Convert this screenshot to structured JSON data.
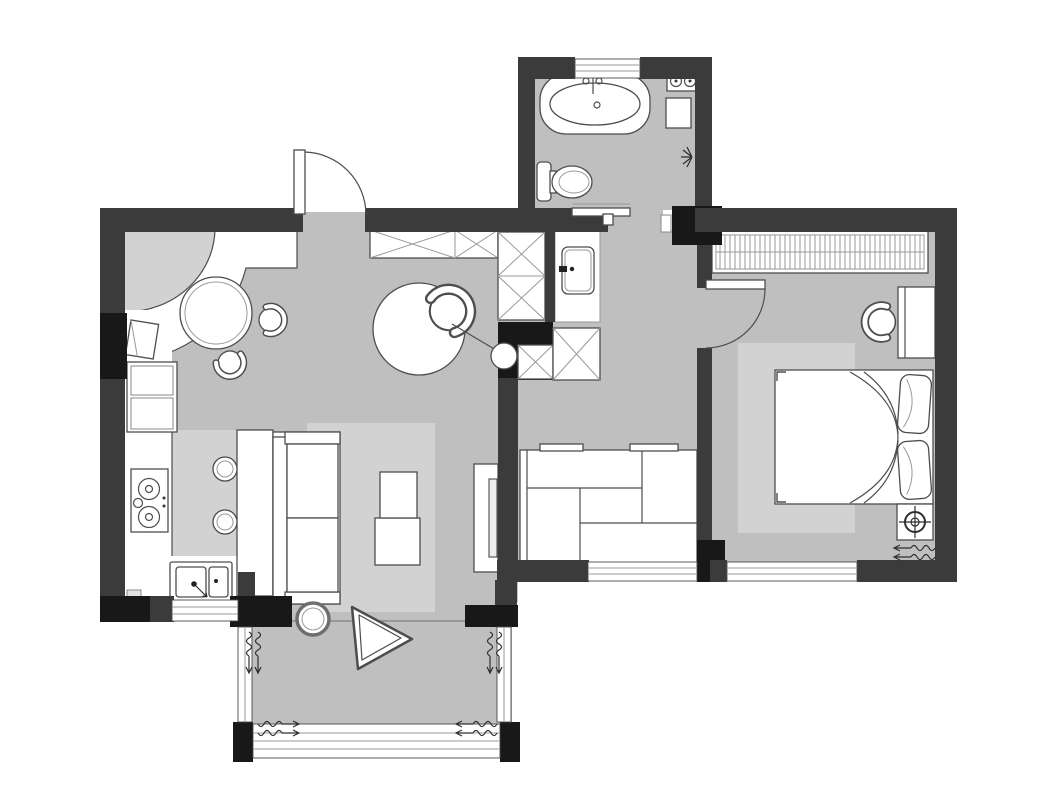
{
  "document": {
    "type": "apartment-floor-plan",
    "style": "top-down black / grey architectural drawing, no text labels",
    "background": "#ffffff"
  },
  "palette": {
    "wall": "#3b3b3b",
    "structural_column": "#181818",
    "floor": "#bfbfbf",
    "floor_light": "#d2d2d2",
    "fixture_fill": "#ffffff",
    "outline": "#4d4d4d",
    "window_line": "#9a9a9a"
  },
  "rooms": [
    {
      "id": "kitchen-dining",
      "label": "Kitchen and dining area",
      "features": [
        "curved countertop in top-left corner",
        "angled fridge",
        "tall two-door cabinet",
        "two-burner gas cooktop",
        "double-bowl sink with drain arrow",
        "window under sink",
        "round dining table",
        "two tub chairs"
      ]
    },
    {
      "id": "entry-hall",
      "label": "Entry hall",
      "features": [
        "outward swinging entry door in top wall",
        "row of X storage cabinets",
        "column of X storage cabinets",
        "round rug",
        "tub armchair",
        "floor lamp with small round head"
      ]
    },
    {
      "id": "living-room",
      "label": "Living room",
      "features": [
        "bar console behind sofa",
        "two round bar stools",
        "two-seat sofa facing east",
        "light grey rug",
        "two-piece coffee table",
        "TV on low cabinet against partition wall",
        "south window"
      ]
    },
    {
      "id": "inner-hall-nook",
      "label": "Inner hall and storage nook",
      "features": [
        "washbasin vanity outside bathroom",
        "X cabinets beside vanity",
        "large staggered-panel storage cabinet with two handles",
        "south window"
      ]
    },
    {
      "id": "bathroom",
      "label": "Bathroom",
      "features": [
        "oval bathtub with wall faucet",
        "top-wall window",
        "washer unit with two round lids",
        "small square stool",
        "toilet facing east",
        "wall light starburst",
        "sliding entry door with track bar"
      ]
    },
    {
      "id": "bedroom",
      "label": "Bedroom",
      "features": [
        "full-width sliding wardrobe with hatch lines",
        "swing door from hall",
        "desk against east wall",
        "tub desk chair",
        "double bed with duvet sweep curves",
        "two pillows at east headboard",
        "light grey rug",
        "white box with circled-cross target symbol",
        "south window"
      ]
    },
    {
      "id": "balcony",
      "label": "Balcony",
      "features": [
        "full-width bottom window band",
        "left and right side windows",
        "corner structural columns",
        "rounded triangle decor piece",
        "round side table at threshold",
        "airflow squiggle arrows"
      ]
    }
  ],
  "symbols": {
    "airflow": "wavy spring line with leftward arrow, drawn in pairs at window openings",
    "wall_light": "small starburst on bathroom east wall",
    "floor_target": "circle with crosshair inside white box near bed"
  }
}
